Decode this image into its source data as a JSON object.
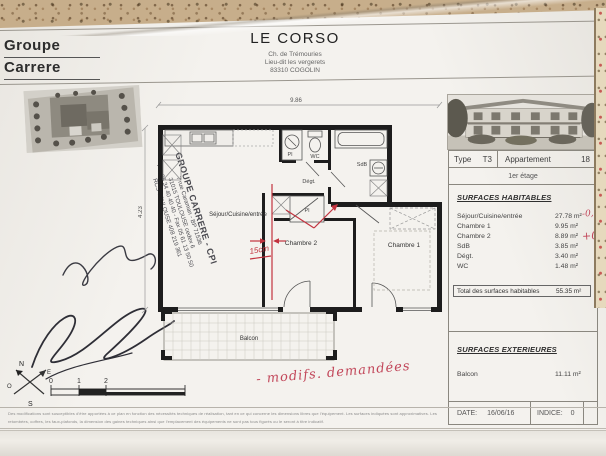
{
  "header": {
    "company_line1": "Groupe",
    "company_line2": "Carrere",
    "title": "LE CORSO",
    "address_line1": "Ch. de Trémouries",
    "address_line2": "Lieu-dit les vergerets",
    "address_line3": "83310 COGOLIN"
  },
  "stamp": {
    "line1": "GROUPE CARRERE - CPI",
    "line2": "7 rue Caraman - BP 71536",
    "line3": "31015 TOULOUSE cedex 6",
    "line4": "Tél. 05 34 40 40 40 - Fax 05 61 13 50 50",
    "line5": "RCS TOULOUSE 408 219 361"
  },
  "plan": {
    "dim_width": "9.86",
    "dim_height": "4.23",
    "rooms": {
      "sejour": "Séjour/Cuisine/entrée",
      "chambre2": "Chambre 2",
      "chambre1": "Chambre 1",
      "balcon": "Balcon",
      "wc": "WC",
      "sdb": "SdB",
      "degt": "Dégt.",
      "pl_upper": "Pl",
      "pl_lower": "Pl"
    },
    "annotations": {
      "measure": "15cm",
      "note": "- modifs. demandées"
    }
  },
  "info_table": {
    "type_label": "Type",
    "type_value": "T3",
    "apt_label": "Appartement",
    "apt_value": "18",
    "floor": "1er étage",
    "surfaces_habitables": {
      "title": "SURFACES HABITABLES",
      "rows": [
        {
          "label": "Séjour/Cuisine/entrée",
          "value": "27.78 m²"
        },
        {
          "label": "Chambre 1",
          "value": "9.95 m²"
        },
        {
          "label": "Chambre 2",
          "value": "8.89 m²"
        },
        {
          "label": "SdB",
          "value": "3.85 m²"
        },
        {
          "label": "Dégt.",
          "value": "3.40 m²"
        },
        {
          "label": "WC",
          "value": "1.48 m²"
        }
      ],
      "red_annotation_row0": "-0,5",
      "red_annotation_row2": "+0,5",
      "total_label": "Total des surfaces habitables",
      "total_value": "55.35 m²"
    },
    "surfaces_exterieures": {
      "title": "SURFACES EXTERIEURES",
      "balcon_label": "Balcon",
      "balcon_value": "11.11 m²"
    },
    "date_label": "DATE:",
    "date_value": "16/06/16",
    "indice_label": "INDICE:",
    "indice_value": "0"
  },
  "compass": {
    "n": "N",
    "e": "E",
    "s": "S",
    "o": "O"
  },
  "scale_bar": {
    "ticks": [
      "0",
      "1",
      "2",
      "5"
    ]
  },
  "footer": {
    "line1": "Des modifications sont susceptibles d'être apportées à ce plan en fonction des nécessités techniques de réalisation, tant en ce qui concerne les dimensions libres que l'équipement. Les surfaces indiquées sont approximatives. Les",
    "line2": "retombées, coffres, les faux-plafonds, la dimension des gaines techniques ainsi que l'emplacement des équipements ne sont pas tous figurés ou le seront à titre indicatif."
  }
}
